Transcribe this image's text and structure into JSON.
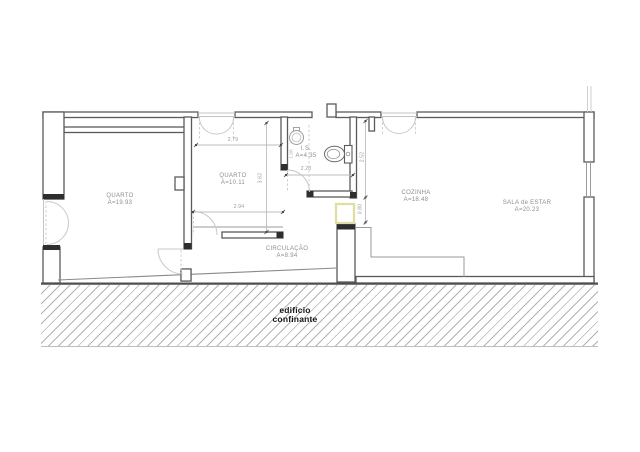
{
  "plan": {
    "title": "apartment floor plan",
    "rooms": [
      {
        "id": "quarto-1",
        "name": "QUARTO",
        "area": "A=19.93"
      },
      {
        "id": "quarto-2",
        "name": "QUARTO",
        "area": "A=10.11"
      },
      {
        "id": "is",
        "name": "I.S.",
        "area": "A=4.35"
      },
      {
        "id": "cozinha",
        "name": "COZINHA",
        "area": "A=18.48"
      },
      {
        "id": "sala",
        "name": "SALA de ESTAR",
        "area": "A=20.23"
      },
      {
        "id": "circulacao",
        "name": "CIRCULAÇÃO",
        "area": "A=8.94"
      }
    ],
    "dimensions": [
      {
        "id": "d-279",
        "value": "2.79",
        "orientation": "horizontal"
      },
      {
        "id": "d-362",
        "value": "3.62",
        "orientation": "vertical"
      },
      {
        "id": "d-294",
        "value": "2.94",
        "orientation": "horizontal"
      },
      {
        "id": "d-220",
        "value": "2.20",
        "orientation": "horizontal"
      },
      {
        "id": "d-198",
        "value": "1.98",
        "orientation": "vertical"
      },
      {
        "id": "d-252",
        "value": "2.52",
        "orientation": "vertical"
      },
      {
        "id": "d-080",
        "value": "0.80",
        "orientation": "vertical"
      }
    ],
    "adjacent_building": {
      "line1": "edifício",
      "line2": "confinante"
    },
    "colors": {
      "wall_outline": "#5a5a5a",
      "wall_cap": "#2e2e2e",
      "swing_arc": "#c8c8c8",
      "dim_line": "#bdbdbd",
      "annotation_text": "#9a9a9a",
      "room_text": "#8f8f8f",
      "hatch_line": "#b3b3b3",
      "highlight_square": "#e2dba2"
    }
  }
}
